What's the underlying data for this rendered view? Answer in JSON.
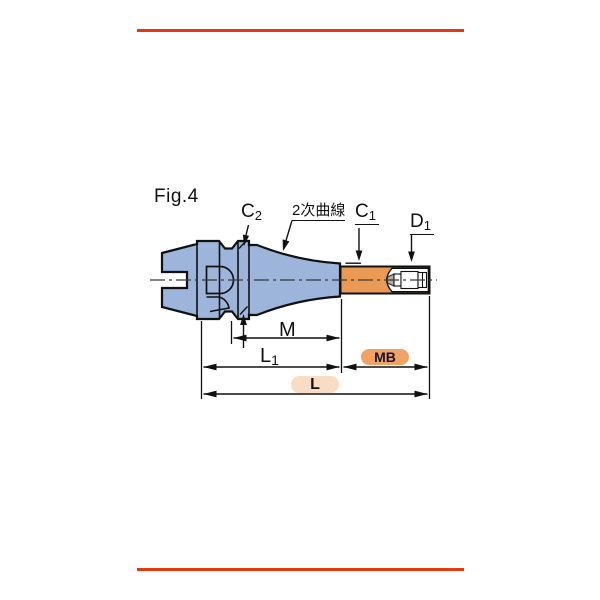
{
  "figure": {
    "title": "Fig.4"
  },
  "annotations": {
    "c2": {
      "main": "C",
      "sub": "2"
    },
    "curve_note": "2次曲線",
    "c1": {
      "main": "C",
      "sub": "1"
    },
    "d1": {
      "main": "D",
      "sub": "1"
    }
  },
  "dimensions": {
    "m": "M",
    "l1": {
      "main": "L",
      "sub": "1"
    },
    "mb": "MB",
    "l": "L"
  },
  "colors": {
    "rule_red": "#e8380d",
    "body_blue_fill": "#9db5da",
    "shaft_orange_fill": "#eb9a55",
    "mb_pill_fill": "#f1a366",
    "l_pill_fill": "#f8dcc3",
    "line_black": "#111111"
  }
}
